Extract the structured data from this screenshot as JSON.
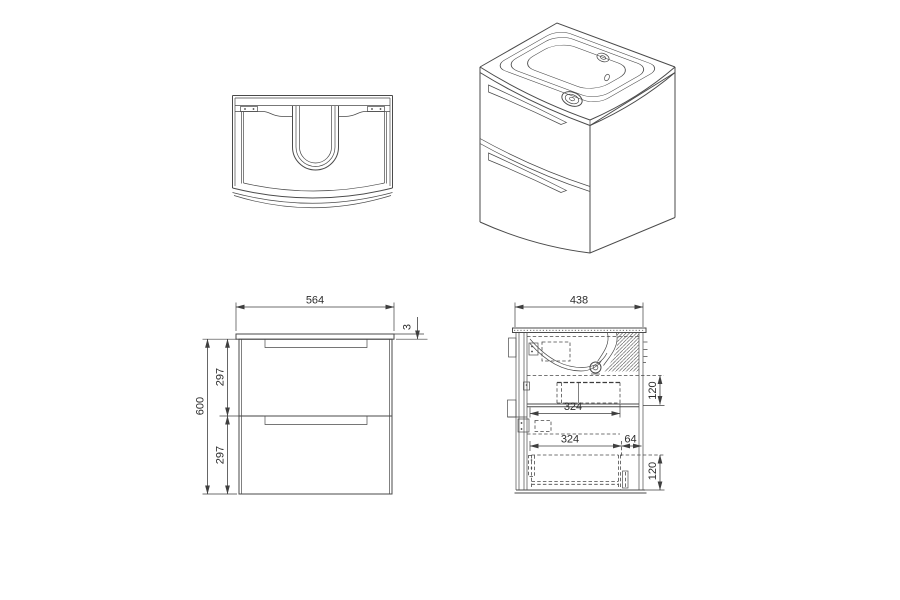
{
  "drawing": {
    "background": "#ffffff",
    "line_color": "#4a4a4a",
    "dimension_color": "#3f3f3f",
    "dimensions": {
      "front": {
        "width": "564",
        "counter_thickness": "3",
        "height": "600",
        "upper_drawer_height": "297",
        "lower_drawer_height": "297"
      },
      "side": {
        "depth": "438",
        "upper_drawer_depth": "324",
        "upper_drawer_height": "120",
        "lower_drawer_depth": "324",
        "back_clearance": "64",
        "lower_drawer_height": "120"
      }
    }
  }
}
